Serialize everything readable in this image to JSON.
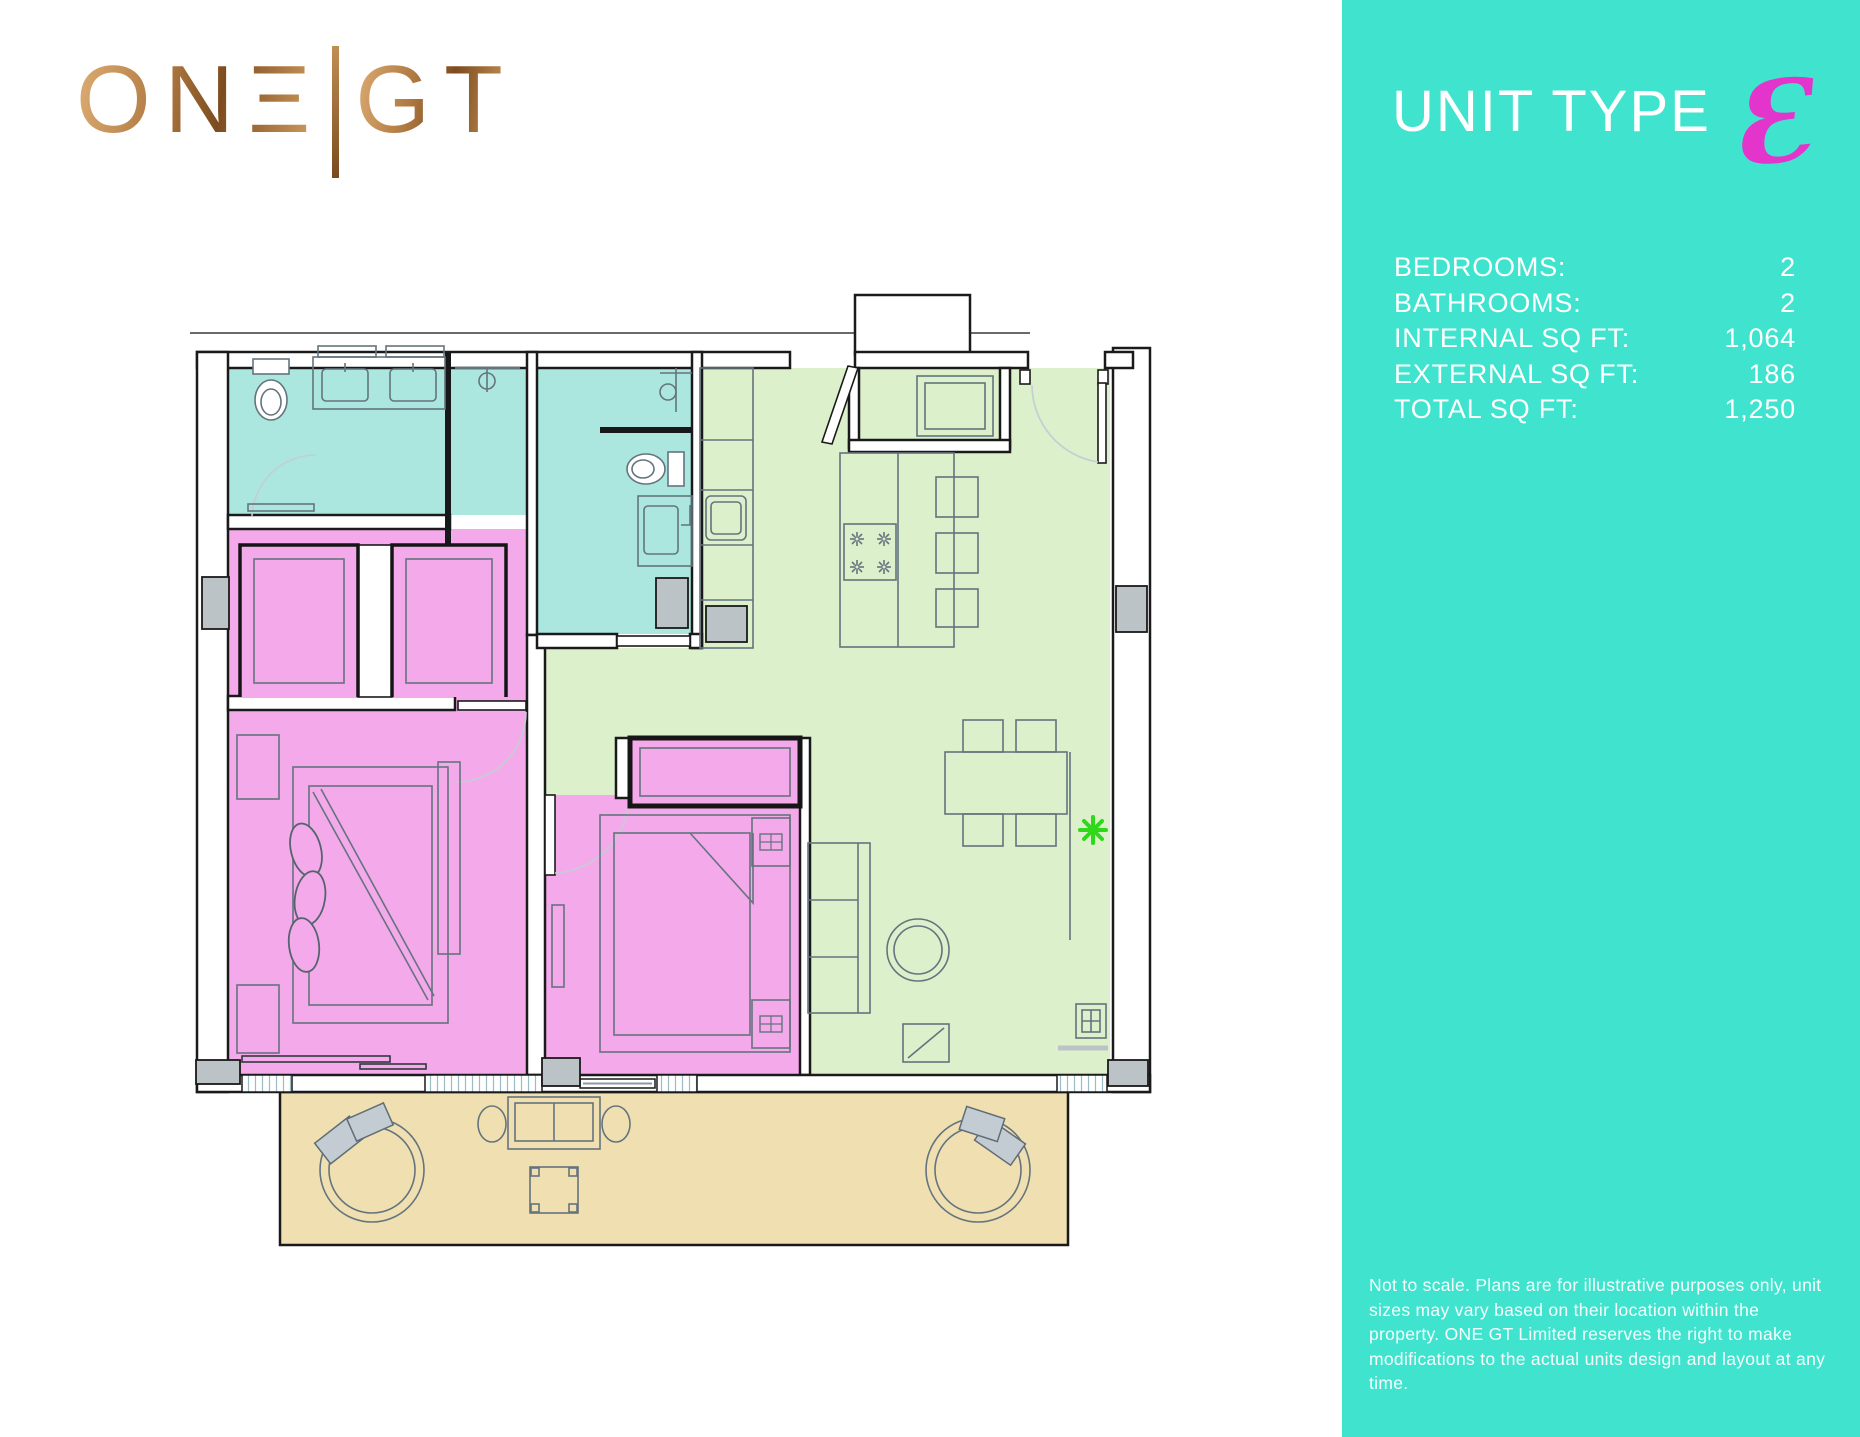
{
  "brand": {
    "logo_left": "ONΞ",
    "logo_divider": "|",
    "logo_right": "GT"
  },
  "sidebar": {
    "title": "UNIT TYPE",
    "unit_letter": "E",
    "unit_letter_glyph": "Ɛ",
    "specs": [
      {
        "label": "BEDROOMS:",
        "value": "2"
      },
      {
        "label": "BATHROOMS:",
        "value": "2"
      },
      {
        "label": "INTERNAL SQ FT:",
        "value": "1,064"
      },
      {
        "label": "EXTERNAL SQ FT:",
        "value": "186"
      },
      {
        "label": "TOTAL SQ FT:",
        "value": "1,250"
      }
    ],
    "disclaimer": "Not to scale. Plans are for illustrative purposes only, unit sizes may vary based on their location within the property. ONE GT Limited reserves the right to make modifications to the actual units design and layout at any time."
  },
  "floor_plan": {
    "rooms": [
      "bathroom-1",
      "bathroom-2",
      "closet-area",
      "bedroom-1",
      "bedroom-2",
      "kitchen",
      "living-dining",
      "entry-hall",
      "terrace"
    ],
    "legend": {
      "pink": "bedrooms",
      "teal": "bathrooms",
      "green": "kitchen-living",
      "sand": "terrace"
    }
  },
  "colors": {
    "teal": "#40E4CE",
    "magenta": "#E335CC",
    "pink": "#F4A9EA",
    "bath": "#ABE7DF",
    "green": "#DBF0CB",
    "sand": "#F0DFB0",
    "gray": "#BCC3C7"
  }
}
